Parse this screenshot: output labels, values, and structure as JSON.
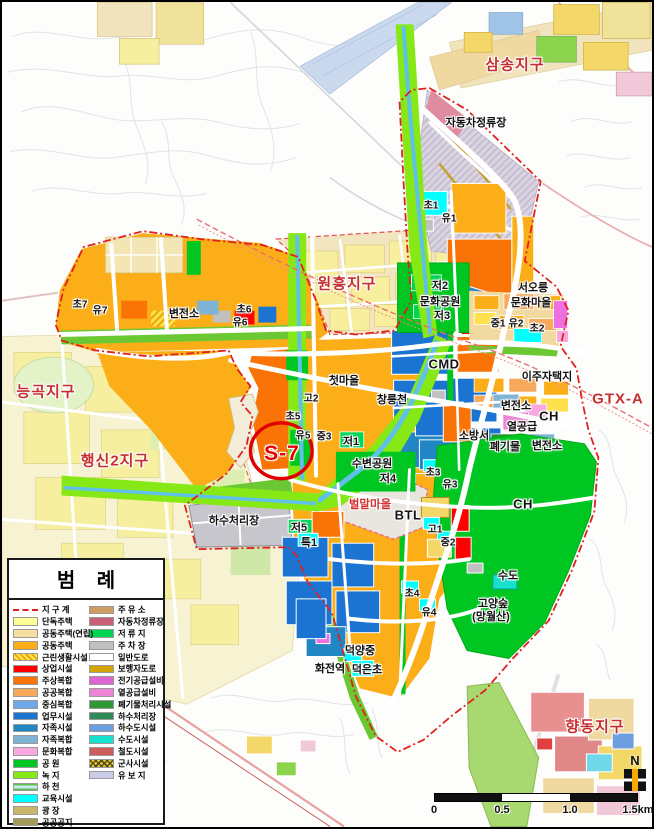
{
  "legend": {
    "title": "범  례",
    "columns": {
      "left": [
        {
          "label": "지 구 계",
          "swatch": "boundary",
          "color": "#E02020"
        },
        {
          "label": "단독주택",
          "swatch": "color",
          "color": "#FFFF99"
        },
        {
          "label": "공동주택(연립)",
          "swatch": "color",
          "color": "#F6DFA0"
        },
        {
          "label": "공동주택",
          "swatch": "color",
          "color": "#FBAE17"
        },
        {
          "label": "근린생활시설",
          "swatch": "hatch",
          "color": "#FFE14D"
        },
        {
          "label": "상업시설",
          "swatch": "color",
          "color": "#FE0000"
        },
        {
          "label": "주상복합",
          "swatch": "color",
          "color": "#F97306"
        },
        {
          "label": "공공복합",
          "swatch": "color",
          "color": "#F6A95B"
        },
        {
          "label": "중심복합",
          "swatch": "color",
          "color": "#6FA8E8"
        },
        {
          "label": "업무시설",
          "swatch": "color",
          "color": "#1C74D2"
        },
        {
          "label": "자족시설",
          "swatch": "color",
          "color": "#2187C4"
        },
        {
          "label": "자족복합",
          "swatch": "color",
          "color": "#7FB4D6"
        },
        {
          "label": "문화복합",
          "swatch": "color",
          "color": "#F9A8DF"
        },
        {
          "label": "공  원",
          "swatch": "color",
          "color": "#00C621"
        },
        {
          "label": "녹  지",
          "swatch": "color",
          "color": "#86E815"
        },
        {
          "label": "하  천",
          "swatch": "stream",
          "color": "#C8ECF4"
        },
        {
          "label": "교육시설",
          "swatch": "color",
          "color": "#00FFFF"
        },
        {
          "label": "광  장",
          "swatch": "color",
          "color": "#C9B769"
        },
        {
          "label": "공공공지",
          "swatch": "color",
          "color": "#A39A55"
        },
        {
          "label": "종교시설",
          "swatch": "color",
          "color": "#EE6FE2"
        }
      ],
      "right": [
        {
          "label": "주 유 소",
          "swatch": "color",
          "color": "#CE9C62"
        },
        {
          "label": "자동차정류장",
          "swatch": "color",
          "color": "#C9607A"
        },
        {
          "label": "저 류 지",
          "swatch": "color",
          "color": "#00D455"
        },
        {
          "label": "주 차 장",
          "swatch": "color",
          "color": "#C0C0C0"
        },
        {
          "label": "일반도로",
          "swatch": "road",
          "color": "#FFFFFF"
        },
        {
          "label": "보행자도로",
          "swatch": "color",
          "color": "#D3A50A"
        },
        {
          "label": "전기공급설비",
          "swatch": "color",
          "color": "#DC66D2"
        },
        {
          "label": "열공급설비",
          "swatch": "color",
          "color": "#ED85D5"
        },
        {
          "label": "폐기물처리시설",
          "swatch": "color",
          "color": "#2E9934"
        },
        {
          "label": "하수처리장",
          "swatch": "color",
          "color": "#2E8B57"
        },
        {
          "label": "하수도시설",
          "swatch": "color",
          "color": "#6D9FE0"
        },
        {
          "label": "수도시설",
          "swatch": "color",
          "color": "#16E0CE"
        },
        {
          "label": "철도시설",
          "swatch": "color",
          "color": "#CD5C5C"
        },
        {
          "label": "군사시설",
          "swatch": "military",
          "color": "#D8C840"
        },
        {
          "label": "유 보 지",
          "swatch": "color",
          "color": "#CBCBEA"
        }
      ]
    }
  },
  "map": {
    "labels": [
      {
        "text": "삼송지구",
        "x": 513,
        "y": 62,
        "cls": "d"
      },
      {
        "text": "자동차정류장",
        "x": 474,
        "y": 120,
        "cls": "b"
      },
      {
        "text": "초1",
        "x": 429,
        "y": 202,
        "cls": "s"
      },
      {
        "text": "유1",
        "x": 447,
        "y": 215,
        "cls": "s"
      },
      {
        "text": "원흥지구",
        "x": 345,
        "y": 281,
        "cls": "d"
      },
      {
        "text": "저2",
        "x": 438,
        "y": 283,
        "cls": "b"
      },
      {
        "text": "문화공원",
        "x": 438,
        "y": 299,
        "cls": "b"
      },
      {
        "text": "저3",
        "x": 440,
        "y": 313,
        "cls": "b"
      },
      {
        "text": "서오릉",
        "x": 531,
        "y": 285,
        "cls": "b"
      },
      {
        "text": "문화마을",
        "x": 529,
        "y": 300,
        "cls": "b"
      },
      {
        "text": "중1",
        "x": 496,
        "y": 320,
        "cls": "s"
      },
      {
        "text": "유2",
        "x": 514,
        "y": 320,
        "cls": "s"
      },
      {
        "text": "초2",
        "x": 535,
        "y": 325,
        "cls": "s"
      },
      {
        "text": "변전소",
        "x": 182,
        "y": 311,
        "cls": "b"
      },
      {
        "text": "초6",
        "x": 242,
        "y": 306,
        "cls": "s"
      },
      {
        "text": "유6",
        "x": 238,
        "y": 319,
        "cls": "s"
      },
      {
        "text": "초7",
        "x": 78,
        "y": 301,
        "cls": "s"
      },
      {
        "text": "유7",
        "x": 98,
        "y": 307,
        "cls": "s"
      },
      {
        "text": "능곡지구",
        "x": 44,
        "y": 389,
        "cls": "d"
      },
      {
        "text": "CMD",
        "x": 442,
        "y": 362,
        "cls": "b2"
      },
      {
        "text": "이주자택지",
        "x": 545,
        "y": 374,
        "cls": "b"
      },
      {
        "text": "GTX-A",
        "x": 616,
        "y": 397,
        "cls": "d"
      },
      {
        "text": "첫마을",
        "x": 342,
        "y": 378,
        "cls": "b"
      },
      {
        "text": "창릉천",
        "x": 390,
        "y": 397,
        "cls": "b"
      },
      {
        "text": "변전소",
        "x": 514,
        "y": 403,
        "cls": "b"
      },
      {
        "text": "CH",
        "x": 547,
        "y": 414,
        "cls": "b2"
      },
      {
        "text": "열공급",
        "x": 520,
        "y": 424,
        "cls": "b"
      },
      {
        "text": "소방서",
        "x": 472,
        "y": 433,
        "cls": "b"
      },
      {
        "text": "폐기물",
        "x": 503,
        "y": 444,
        "cls": "b"
      },
      {
        "text": "변전소",
        "x": 545,
        "y": 443,
        "cls": "b"
      },
      {
        "text": "고2",
        "x": 309,
        "y": 395,
        "cls": "s"
      },
      {
        "text": "초5",
        "x": 291,
        "y": 413,
        "cls": "s"
      },
      {
        "text": "유5",
        "x": 301,
        "y": 432,
        "cls": "s"
      },
      {
        "text": "중3",
        "x": 322,
        "y": 433,
        "cls": "s"
      },
      {
        "text": "저1",
        "x": 349,
        "y": 439,
        "cls": "b"
      },
      {
        "text": "행신2지구",
        "x": 113,
        "y": 458,
        "cls": "d"
      },
      {
        "text": "수변공원",
        "x": 370,
        "y": 461,
        "cls": "b"
      },
      {
        "text": "저4",
        "x": 386,
        "y": 476,
        "cls": "b"
      },
      {
        "text": "초3",
        "x": 431,
        "y": 469,
        "cls": "s"
      },
      {
        "text": "유3",
        "x": 448,
        "y": 481,
        "cls": "s"
      },
      {
        "text": "CH",
        "x": 521,
        "y": 502,
        "cls": "b2"
      },
      {
        "text": "벌말마을",
        "x": 368,
        "y": 502,
        "cls": "r"
      },
      {
        "text": "BTL",
        "x": 406,
        "y": 513,
        "cls": "b2"
      },
      {
        "text": "하수처리장",
        "x": 232,
        "y": 518,
        "cls": "b"
      },
      {
        "text": "저5",
        "x": 297,
        "y": 525,
        "cls": "b"
      },
      {
        "text": "특1",
        "x": 307,
        "y": 540,
        "cls": "b"
      },
      {
        "text": "고1",
        "x": 433,
        "y": 526,
        "cls": "s"
      },
      {
        "text": "중2",
        "x": 446,
        "y": 539,
        "cls": "s"
      },
      {
        "text": "수도",
        "x": 506,
        "y": 573,
        "cls": "b"
      },
      {
        "text": "초4",
        "x": 410,
        "y": 590,
        "cls": "s"
      },
      {
        "text": "유4",
        "x": 427,
        "y": 609,
        "cls": "s"
      },
      {
        "text": "고양숲",
        "x": 491,
        "y": 601,
        "cls": "b"
      },
      {
        "text": "(망월산)",
        "x": 489,
        "y": 614,
        "cls": "b"
      },
      {
        "text": "덕양중",
        "x": 358,
        "y": 648,
        "cls": "b"
      },
      {
        "text": "화전역",
        "x": 328,
        "y": 666,
        "cls": "b"
      },
      {
        "text": "덕은초",
        "x": 365,
        "y": 667,
        "cls": "b"
      },
      {
        "text": "향동지구",
        "x": 593,
        "y": 724,
        "cls": "d"
      },
      {
        "text": "S-7",
        "x": 280,
        "y": 452,
        "cls": "s7"
      }
    ]
  },
  "compass": {
    "label": "N"
  },
  "scalebar": {
    "ticks": [
      "0",
      "0.5",
      "1.0",
      "1.5km"
    ]
  }
}
